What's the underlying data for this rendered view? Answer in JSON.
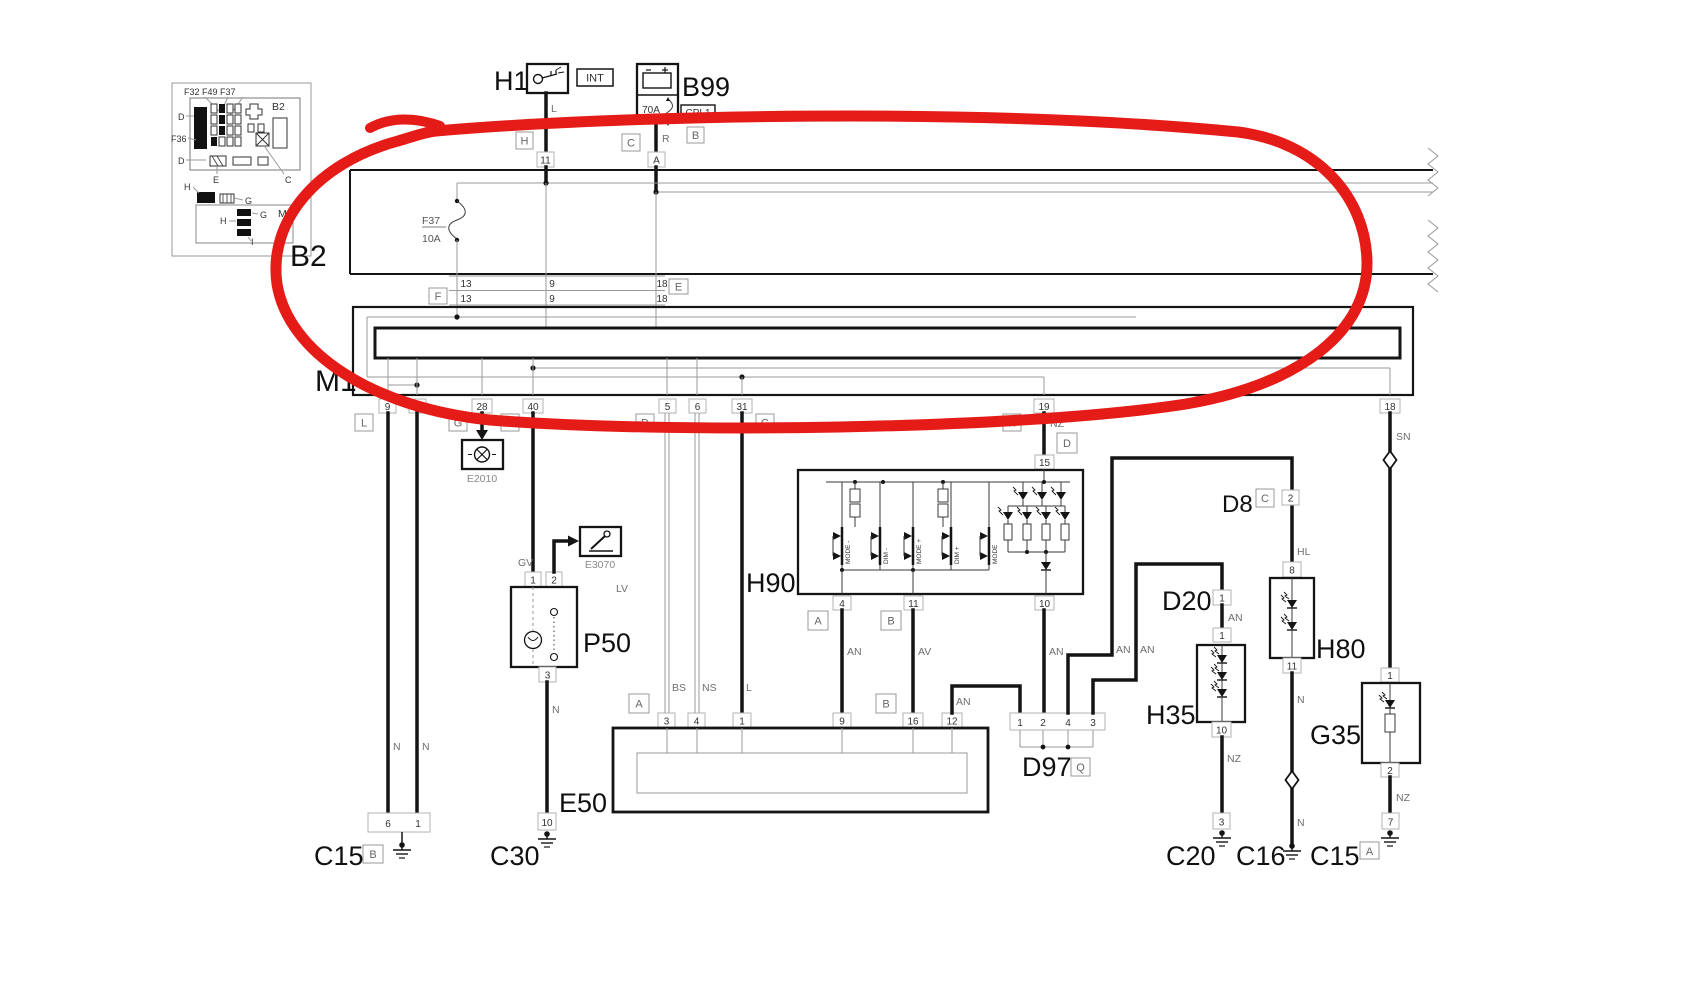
{
  "colors": {
    "wire": "#141414",
    "thin_line": "#9a9a9a",
    "red_loop": "#e51b17",
    "pin_box_border": "#b3b3b3"
  },
  "inset": {
    "fuse_row": "F32  F49  F37",
    "b2": "B2",
    "d_top": "D",
    "f36": "F36",
    "d_mid": "D",
    "e": "E",
    "c": "C",
    "h_top": "H",
    "g_top": "G",
    "m1": "M1",
    "h_in": "H",
    "g_in": "G",
    "i": "I"
  },
  "h1": {
    "name": "H1",
    "tag": "INT",
    "wire": "L",
    "conn": "H",
    "pin": "11"
  },
  "b99": {
    "name": "B99",
    "fuse": "70A",
    "tag": "CPL1",
    "conn_b": "B",
    "conn_c": "C",
    "wire": "R",
    "pin": "A"
  },
  "b2": {
    "name": "B2",
    "fuse_name": "F37",
    "fuse_amp": "10A",
    "rows": [
      [
        "13",
        "9",
        "18"
      ],
      [
        "13",
        "9",
        "18"
      ]
    ],
    "conn_f": "F",
    "conn_e": "E"
  },
  "m1": {
    "name": "M1",
    "pins": [
      "9",
      "8",
      "28",
      "40",
      "5",
      "6",
      "31",
      "19",
      "18"
    ],
    "conn_l": "L",
    "conn_g1": "G",
    "conn_e": "E",
    "conn_d": "D",
    "conn_g2": "G",
    "conn_h": "H",
    "wire_nz": "NZ",
    "conn_d2": "D",
    "wire_sn": "SN"
  },
  "left": {
    "wire_n1": "N",
    "wire_n2": "N",
    "c15": {
      "name": "C15",
      "conn": "B",
      "pin_a": "6",
      "pin_b": "1"
    }
  },
  "e2010": {
    "name": "E2010"
  },
  "e3070": {
    "name": "E3070"
  },
  "p50": {
    "name": "P50",
    "pin1": "1",
    "pin2": "2",
    "pin3": "3",
    "wire_gv_top": "GV",
    "wire_gv": "GV",
    "wire_lv": "LV",
    "wire_n": "N",
    "c30": {
      "name": "C30",
      "pin": "10"
    }
  },
  "e50": {
    "name": "E50",
    "pins": [
      "3",
      "4",
      "1",
      "9",
      "16",
      "12"
    ],
    "conn_a": "A",
    "conn_b": "B",
    "wire_bs": "BS",
    "wire_ns": "NS",
    "wire_l": "L",
    "wire_an": "AN"
  },
  "h90": {
    "name": "H90",
    "pin15": "15",
    "pin4": "4",
    "pin11": "11",
    "pin10": "10",
    "conn_a": "A",
    "conn_b": "B",
    "wire_an": "AN",
    "wire_av": "AV",
    "wire_an10": "AN",
    "switches": [
      "MODE -",
      "DIM -",
      "MODE +",
      "DIM +",
      "MODE"
    ]
  },
  "d97": {
    "name": "D97",
    "conn_q": "Q",
    "pins": [
      "1",
      "2",
      "4",
      "3"
    ],
    "wire_an_leg1": "AN",
    "wire_an_leg2": "AN"
  },
  "d8": {
    "name": "D8",
    "conn_c": "C",
    "pin": "2",
    "wire_hl": "HL"
  },
  "d20": {
    "name": "D20",
    "pin": "1",
    "wire_an": "AN"
  },
  "h35": {
    "name": "H35",
    "pin_top": "1",
    "pin_bot": "10",
    "wire_nz": "NZ",
    "c20": {
      "name": "C20",
      "pin": "3"
    }
  },
  "h80": {
    "name": "H80",
    "pin_top": "8",
    "pin_bot": "11",
    "wire_n_top": "N",
    "wire_n_bot": "N",
    "c16": {
      "name": "C16"
    }
  },
  "g35": {
    "name": "G35",
    "pin_top": "1",
    "pin_bot": "2",
    "wire_nz": "NZ",
    "c15": {
      "name": "C15",
      "conn": "A",
      "pin": "7"
    }
  }
}
